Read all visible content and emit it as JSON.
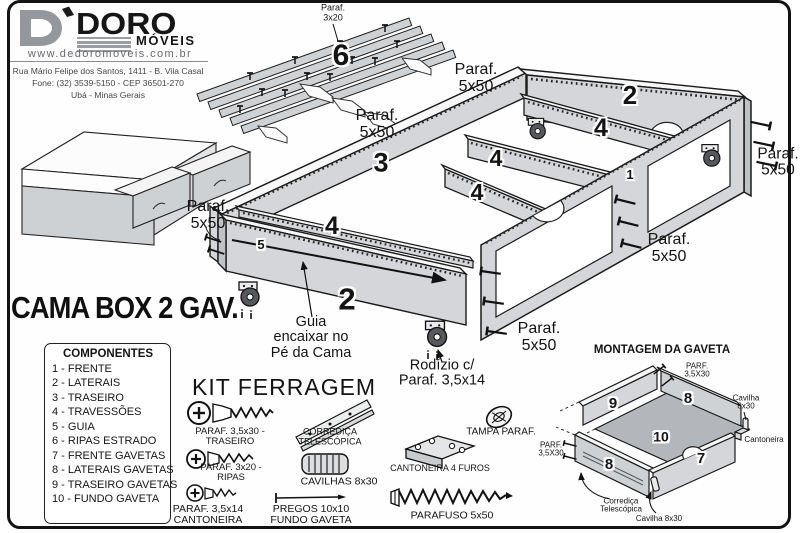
{
  "logo": {
    "brand": "DORO",
    "brand_sub": "MÓVEIS",
    "website": "www.dedoromoveis.com.br",
    "address1": "Rua Mário Felipe dos Santos, 1411 - B. Vila Casal",
    "address2": "Fone: (32) 3539-5150 - CEP 36501-270",
    "address3": "Ubá - Minas Gerais"
  },
  "title": "CAMA BOX 2 GAV.",
  "components": {
    "title": "COMPONENTES",
    "items": [
      "1 - FRENTE",
      "2 - LATERAIS",
      "3 - TRASEIRO",
      "4 - TRAVESSÕES",
      "5 - GUIA",
      "6 - RIPAS ESTRADO",
      "7 - FRENTE GAVETAS",
      "8 - LATERAIS GAVETAS",
      "9 - TRASEIRO GAVETAS",
      "10 - FUNDO GAVETA"
    ]
  },
  "kit": {
    "title": "KIT FERRAGEM",
    "paraf_3_5x30": "PARAF. 3,5x30 -\nTRASEIRO",
    "corredica": "CORREDIÇA\nTELESCÓPICA",
    "paraf_3x20": "PARAF. 3x20 -\nRIPAS",
    "cavilhas": "CAVILHAS 8x30",
    "paraf_3_5x14": "PARAF. 3,5x14\nCANTONEIRA",
    "pregos": "PREGOS 10x10\nFUNDO GAVETA",
    "tampa": "TAMPA PARAF.",
    "cantoneira_4_furos": "CANTONEIRA 4 FUROS",
    "parafuso_5x50": "PARAFUSO 5x50"
  },
  "diagram": {
    "paraf_5x50": "Paraf.\n5x50",
    "paraf_3x20": "Paraf.\n3x20",
    "guia_note": "Guia\nencaixar no\nPé da Cama",
    "rodizio_note": "Rodízio c/\nParaf. 3,5x14"
  },
  "parts": {
    "p1": "1",
    "p2": "2",
    "p3": "3",
    "p4": "4",
    "p5": "5",
    "p6": "6",
    "p7": "7",
    "p8": "8",
    "p9": "9",
    "p10": "10"
  },
  "montagem": {
    "title": "MONTAGEM DA GAVETA",
    "parf_3_5x30": "PARF.\n3,5X30",
    "cavilha_8x30": "Cavilha\n8x30",
    "cavilha_8x30_line": "Cavilha 8x30",
    "cantoneira": "Cantoneira",
    "corredica": "Corrediça\nTelescópica"
  },
  "colors": {
    "board_face": "#d4d6d9",
    "board_top": "#f6f6f7",
    "board_dark": "#bfc2c5",
    "ink": "#151515",
    "logo_gray": "#94979b"
  }
}
